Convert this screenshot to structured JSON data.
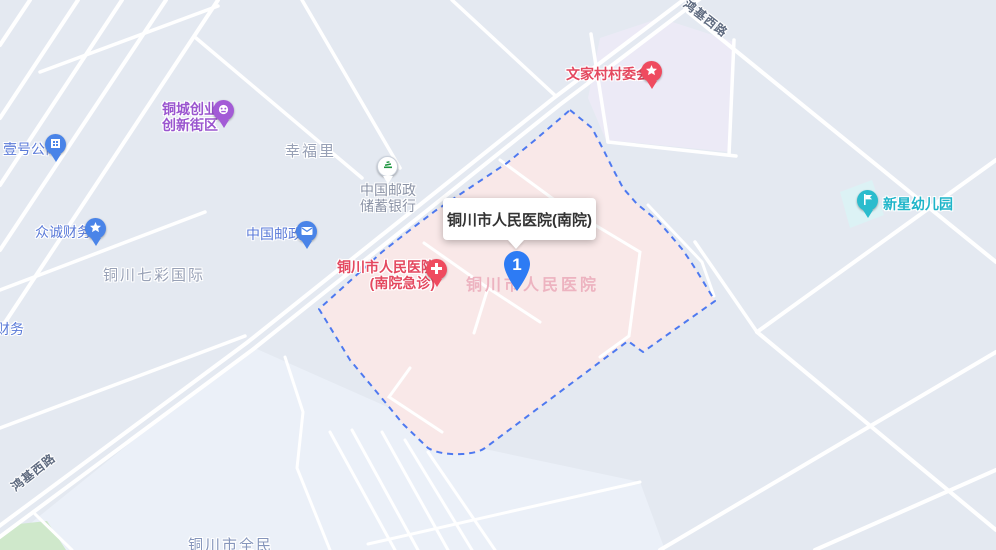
{
  "map": {
    "tooltip": {
      "title": "铜川市人民医院(南院)"
    },
    "selected_marker": {
      "number": "1"
    },
    "highlight_area_label": "铜川市人民医院",
    "roads": [
      {
        "name": "鸿基西路"
      },
      {
        "name": "鸿基西路"
      }
    ],
    "areas": [
      {
        "label": "幸福里"
      },
      {
        "label": "铜川七彩国际"
      },
      {
        "label": "铜川市全民"
      }
    ],
    "pois": [
      {
        "label": "壹号公寓",
        "icon": "building",
        "color": "blue"
      },
      {
        "label": "众诚财务",
        "icon": "star",
        "color": "blue"
      },
      {
        "label": "财务",
        "icon": null,
        "color": "blue"
      },
      {
        "line1": "铜城创业",
        "line2": "创新街区",
        "icon": "badge",
        "color": "purple"
      },
      {
        "line1": "中国邮政",
        "line2": "储蓄银行",
        "icon": "postal-savings",
        "color": "green"
      },
      {
        "label": "中国邮政",
        "icon": "envelope",
        "color": "blue"
      },
      {
        "line1": "铜川市人民医院",
        "line2": "(南院急诊)",
        "icon": "medical-cross",
        "color": "red"
      },
      {
        "label": "文家村村委会",
        "icon": "star",
        "color": "red"
      },
      {
        "label": "新星幼儿园",
        "icon": "flag",
        "color": "teal"
      }
    ],
    "colors": {
      "map_background": "#e4e9f1",
      "highlight_fill": "#f9e8e8",
      "highlight_border": "#4e79f0",
      "selected_marker_blue": "#2d7bf4",
      "road_white": "#ffffff",
      "park_green": "#cfe8cb",
      "lavender_block": "#eceaf6",
      "teal_block": "#dcf2f5",
      "poi_blue": "#5a7ad8",
      "poi_red": "#e4485f",
      "poi_purple": "#9a55cf",
      "poi_teal": "#1fb5c9",
      "poi_gray": "#8a92a5"
    }
  }
}
